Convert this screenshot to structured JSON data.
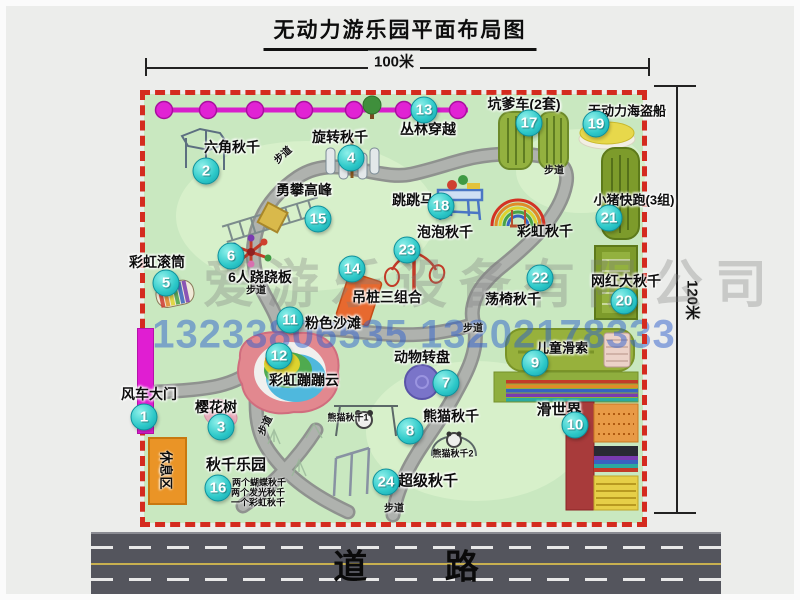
{
  "title": "无动力游乐园平面布局图",
  "dimensions": {
    "top_label": "100米",
    "right_label": "120米"
  },
  "road": {
    "label": "道 路"
  },
  "watermark": {
    "company": "爱游乐设备有限公司",
    "phone": "13233806535 13202178333"
  },
  "path_label_text": "步道",
  "path_labels": [
    {
      "x": 276,
      "y": 148,
      "rot": -42
    },
    {
      "x": 548,
      "y": 163,
      "rot": 0
    },
    {
      "x": 250,
      "y": 283,
      "rot": 0
    },
    {
      "x": 467,
      "y": 321,
      "rot": 0
    },
    {
      "x": 258,
      "y": 419,
      "rot": -65
    },
    {
      "x": 388,
      "y": 501,
      "rot": 0
    }
  ],
  "attractions": [
    {
      "num": "1",
      "label": "风车大门",
      "x": 138,
      "y": 411,
      "label_x": 143,
      "label_y": 388
    },
    {
      "num": "2",
      "label": "六角秋千",
      "x": 200,
      "y": 165,
      "label_x": 226,
      "label_y": 141
    },
    {
      "num": "3",
      "label": "樱花树",
      "x": 215,
      "y": 421,
      "label_x": 210,
      "label_y": 401
    },
    {
      "num": "4",
      "label": "旋转秋千",
      "x": 345,
      "y": 152,
      "label_x": 334,
      "label_y": 131
    },
    {
      "num": "5",
      "label": "彩虹滚筒",
      "x": 160,
      "y": 277,
      "label_x": 151,
      "label_y": 256
    },
    {
      "num": "6",
      "label": "6人跷跷板",
      "x": 225,
      "y": 250,
      "label_x": 254,
      "label_y": 271
    },
    {
      "num": "7",
      "label": "动物转盘",
      "x": 440,
      "y": 377,
      "label_x": 416,
      "label_y": 351
    },
    {
      "num": "8",
      "label": "熊猫秋千",
      "x": 404,
      "y": 425,
      "label_x": 445,
      "label_y": 410
    },
    {
      "num": "9",
      "label": "儿童滑索",
      "x": 529,
      "y": 357,
      "label_x": 556,
      "label_y": 341,
      "label_size": 13
    },
    {
      "num": "10",
      "label": "滑世界",
      "x": 569,
      "y": 419,
      "label_x": 553,
      "label_y": 403,
      "label_size": 15
    },
    {
      "num": "11",
      "label": "粉色沙滩",
      "x": 284,
      "y": 314,
      "label_x": 327,
      "label_y": 317
    },
    {
      "num": "12",
      "label": "彩虹蹦蹦云",
      "x": 273,
      "y": 350,
      "label_x": 298,
      "label_y": 374
    },
    {
      "num": "13",
      "label": "丛林穿越",
      "x": 418,
      "y": 104,
      "label_x": 422,
      "label_y": 123
    },
    {
      "num": "14",
      "label": "吊桩三组合",
      "x": 346,
      "y": 263,
      "label_x": 381,
      "label_y": 291
    },
    {
      "num": "15",
      "label": "勇攀高峰",
      "x": 312,
      "y": 213,
      "label_x": 298,
      "label_y": 184
    },
    {
      "num": "16",
      "label": "秋千乐园",
      "x": 212,
      "y": 482,
      "label_x": 230,
      "label_y": 458,
      "label_size": 15
    },
    {
      "num": "17",
      "label": "坑爹车(2套)",
      "x": 523,
      "y": 117,
      "label_x": 518,
      "label_y": 98
    },
    {
      "num": "18",
      "label": "跳跳马",
      "x": 435,
      "y": 200,
      "label_x": 407,
      "label_y": 194
    },
    {
      "num": "19",
      "label": "无动力海盗船",
      "x": 590,
      "y": 118,
      "label_x": 621,
      "label_y": 104,
      "label_size": 13
    },
    {
      "num": "20",
      "label": "网红大秋千",
      "x": 618,
      "y": 295,
      "label_x": 620,
      "label_y": 275
    },
    {
      "num": "21",
      "label": "小猪快跑(3组)",
      "x": 603,
      "y": 212,
      "label_x": 628,
      "label_y": 193,
      "label_size": 13
    },
    {
      "num": "22",
      "label": "荡椅秋千",
      "x": 534,
      "y": 272,
      "label_x": 507,
      "label_y": 293
    },
    {
      "num": "23",
      "label": "泡泡秋千",
      "x": 401,
      "y": 244,
      "label_x": 439,
      "label_y": 226
    },
    {
      "num": "24",
      "label": "超级秋千",
      "x": 380,
      "y": 476,
      "label_x": 422,
      "label_y": 474,
      "label_size": 15
    }
  ],
  "extra_labels": [
    {
      "text": "彩虹秋千",
      "x": 539,
      "y": 225,
      "size": 14
    },
    {
      "text": "熊猫秋千1",
      "x": 342,
      "y": 411,
      "size": 9
    },
    {
      "text": "熊猫秋千2",
      "x": 447,
      "y": 447,
      "size": 9
    },
    {
      "text": "两个蝴蝶秋千",
      "x": 253,
      "y": 476,
      "size": 9
    },
    {
      "text": "两个发光秋千",
      "x": 252,
      "y": 486,
      "size": 9
    },
    {
      "text": "一个彩虹秋千",
      "x": 252,
      "y": 496,
      "size": 9
    },
    {
      "text": "休息区",
      "x": 161,
      "y": 464,
      "size": 13,
      "rot": 90
    }
  ]
}
